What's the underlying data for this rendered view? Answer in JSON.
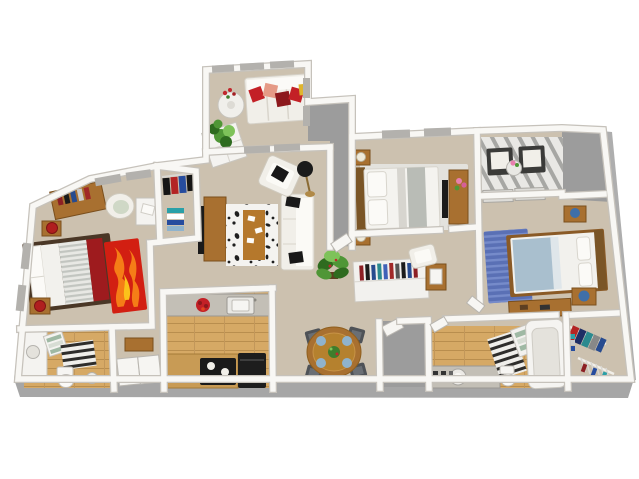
{
  "palette": {
    "background": "#ffffff",
    "carpet": "#ccc1af",
    "carpet_shadow": "#bdb29f",
    "wood_floor": "#d6a965",
    "patio_gray": "#9c9c9c",
    "foundation_gray": "#a6a6a6",
    "wall_white": "#f8f7f4",
    "wall_edge": "#c6c2bb",
    "white_furniture": "#f1efe9",
    "black": "#1a1a1a",
    "wood_furniture": "#a87030",
    "wood_dark": "#7a4f1d",
    "bed_frame_dark": "#4a3726",
    "accent_red": "#c32026",
    "accent_dark_red": "#8c181c",
    "accent_salmon": "#e59a86",
    "accent_yellow": "#dfb52e",
    "flame_red": "#d21f12",
    "flame_orange": "#f57d17",
    "flame_yellow": "#fbc21a",
    "runner_red": "#9e1b1e",
    "lamp_red": "#b01f1f",
    "plant_green": "#4f9636",
    "plant_dark": "#2e6b1f",
    "blue_rug": "#5a70b5",
    "blue_blanket": "#a9bfce",
    "blue_vase": "#3f6fa8",
    "plate_blue": "#8fb3cd",
    "chair_gray": "#4e5257",
    "counter_gray": "#c3bfb6",
    "rug_white": "#f4f3f0",
    "rug_brown": "#b5782c",
    "bedding_gray": "#b9bcb6",
    "towel_green": "#9fb9a4",
    "master_rug": "#e3e2dd",
    "window_cap": "#b3b1ad"
  },
  "rooms": {
    "sunroom_balcony": {
      "label": "Sunroom balcony",
      "items": [
        "white sectional sofa",
        "red, salmon and yellow throw pillows",
        "round white table",
        "red flowers",
        "white planter box with green plant"
      ]
    },
    "living_room": {
      "label": "Living room",
      "items": [
        "white sofa with black pillows",
        "white armchair",
        "black floor lamp",
        "black and white patterned rug",
        "brown coffee table runner with playing cards",
        "wood TV console with flat TV",
        "potted plant",
        "white bookshelf console with colorful books",
        "wood cabinet with picture frame",
        "white accent chair"
      ]
    },
    "entry_porch": {
      "label": "Entry porch",
      "items": [
        "gray concrete floor",
        "front door"
      ]
    },
    "master_bedroom": {
      "label": "Master bedroom",
      "items": [
        "bed with white duvet and gray runner",
        "wood headboard",
        "two nightstands with lamps",
        "wood dresser with TV",
        "pink flowers",
        "pale area rug"
      ]
    },
    "upper_balcony": {
      "label": "Upper patio balcony",
      "items": [
        "slatted deck floor",
        "two dark wicker chairs with white cushions",
        "round bistro table with pink flowers",
        "sliding glass doors"
      ]
    },
    "bedroom_right": {
      "label": "Right bedroom",
      "items": [
        "bed with blue-gray blanket",
        "wood headboard",
        "blue patterned rug",
        "two nightstands with blue vases",
        "wood desk"
      ]
    },
    "bedroom_left": {
      "label": "Left bedroom",
      "items": [
        "bed with white and gray striped bedding and red runner",
        "dark wood bed frame",
        "red flame-pattern rug",
        "two nightstands with red lamps",
        "wood desk with books",
        "green armchair",
        "white side table"
      ]
    },
    "walk_in_closet_left": {
      "label": "Walk-in closet",
      "items": [
        "hanging clothes",
        "folded clothes stacks"
      ]
    },
    "walk_in_closet_right": {
      "label": "Walk-in closet",
      "items": [
        "hanging clothes on rods",
        "hangers",
        "folded clothes"
      ]
    },
    "kitchen": {
      "label": "Kitchen",
      "items": [
        "gray countertop",
        "white sink",
        "red fruit bowl",
        "black range with burners",
        "black refrigerator",
        "oak plank floor"
      ]
    },
    "dining_area": {
      "label": "Dining area",
      "items": [
        "round wood dining table",
        "four dark gray chairs",
        "blue place settings",
        "green centerpiece"
      ]
    },
    "bathroom_left": {
      "label": "Left bathroom",
      "items": [
        "white vanity with sink",
        "towel shelf with green towels",
        "striped rug",
        "toilet",
        "round stool",
        "wood floor"
      ]
    },
    "bathroom_right": {
      "label": "Right bathroom",
      "items": [
        "vanity with round sink",
        "striped shower mat",
        "towel shelf",
        "white bathtub",
        "toilet",
        "wood floor"
      ]
    },
    "hallway": {
      "label": "Hallway",
      "items": [
        "wood bench",
        "white closet doors"
      ]
    },
    "utility_closet": {
      "label": "Utility closet",
      "items": [
        "gray floor",
        "white door"
      ]
    }
  }
}
